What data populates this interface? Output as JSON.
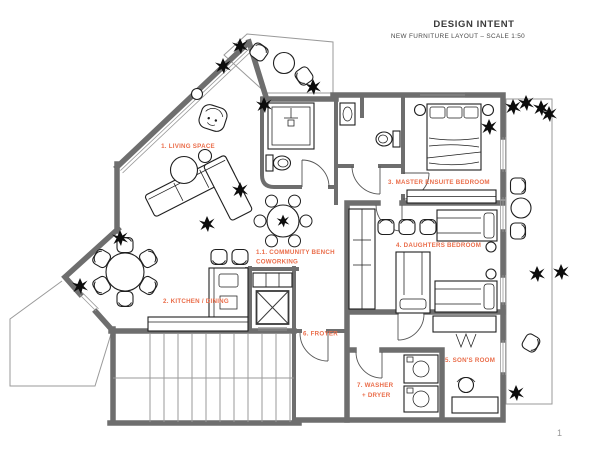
{
  "header": {
    "title": "DESIGN INTENT",
    "subtitle": "NEW FURNITURE LAYOUT – SCALE 1:50"
  },
  "page_number": "1",
  "colors": {
    "label_accent": "#EA6D4A",
    "wall_gray": "#6E6E6E",
    "furniture_line": "#1F1F1F",
    "background": "#FFFFFF"
  },
  "rooms": [
    {
      "id": "living-space",
      "label": "1. LIVING SPACE"
    },
    {
      "id": "community-bench",
      "lines": [
        "1.1. COMMUNITY BENCH",
        "COWORKING"
      ]
    },
    {
      "id": "kitchen-dining",
      "label": "2. KITCHEN / DINING"
    },
    {
      "id": "master-ensuite-bedroom",
      "label": "3. MASTER ENSUITE BEDROOM"
    },
    {
      "id": "daughters-bedroom",
      "label": "4. DAUGHTERS BEDROOM"
    },
    {
      "id": "sons-room",
      "label": "5. SON'S ROOM"
    },
    {
      "id": "foyer",
      "label": "6. FROYER"
    },
    {
      "id": "washer-dryer",
      "lines": [
        "7. WASHER",
        "+ DRYER"
      ]
    }
  ]
}
